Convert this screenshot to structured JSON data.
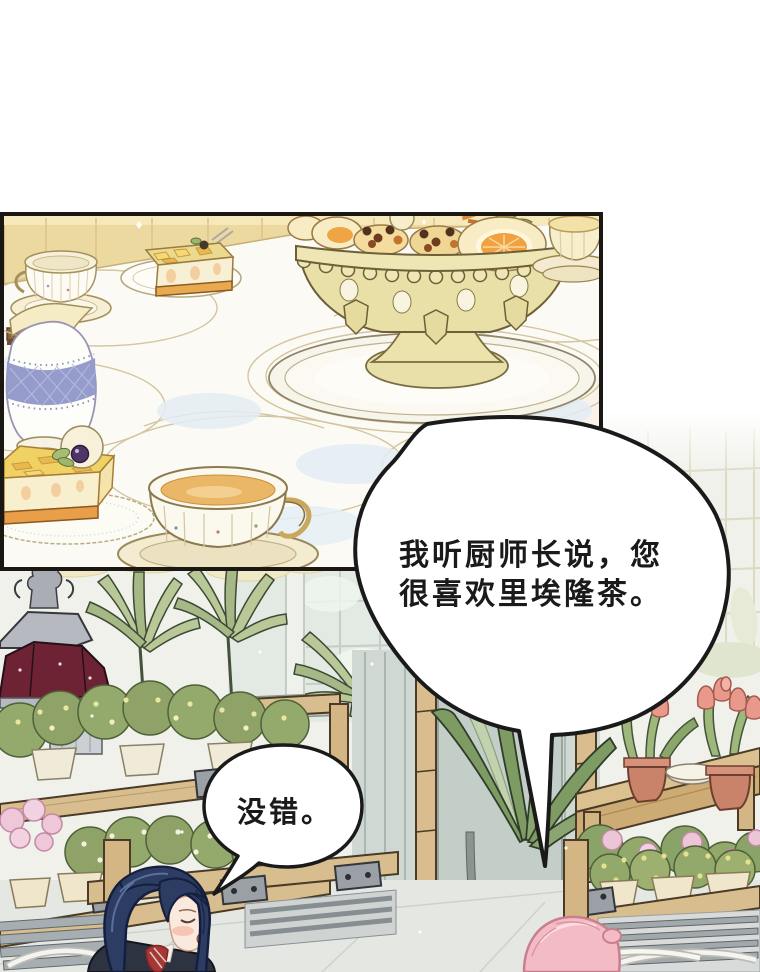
{
  "bubbles": {
    "main": {
      "line1": "我听厨师长说，您",
      "line2": "很喜欢里埃隆茶。"
    },
    "reply": {
      "text": "没错。"
    }
  },
  "palette": {
    "ink": "#1a1a1a",
    "panel_border": "#1b1713",
    "bubble_fill": "#ffffff",
    "roof_maroon": "#6d2334",
    "shelf_wood": "#d8bd8e",
    "hair_blue": "#2c3c63",
    "hair_pink": "#f3bcc4",
    "tea_amber": "#e9b766",
    "tablecloth_blue": "#e4eef6",
    "palm_green": "#b9c897",
    "tulip_pink": "#e9998b"
  }
}
